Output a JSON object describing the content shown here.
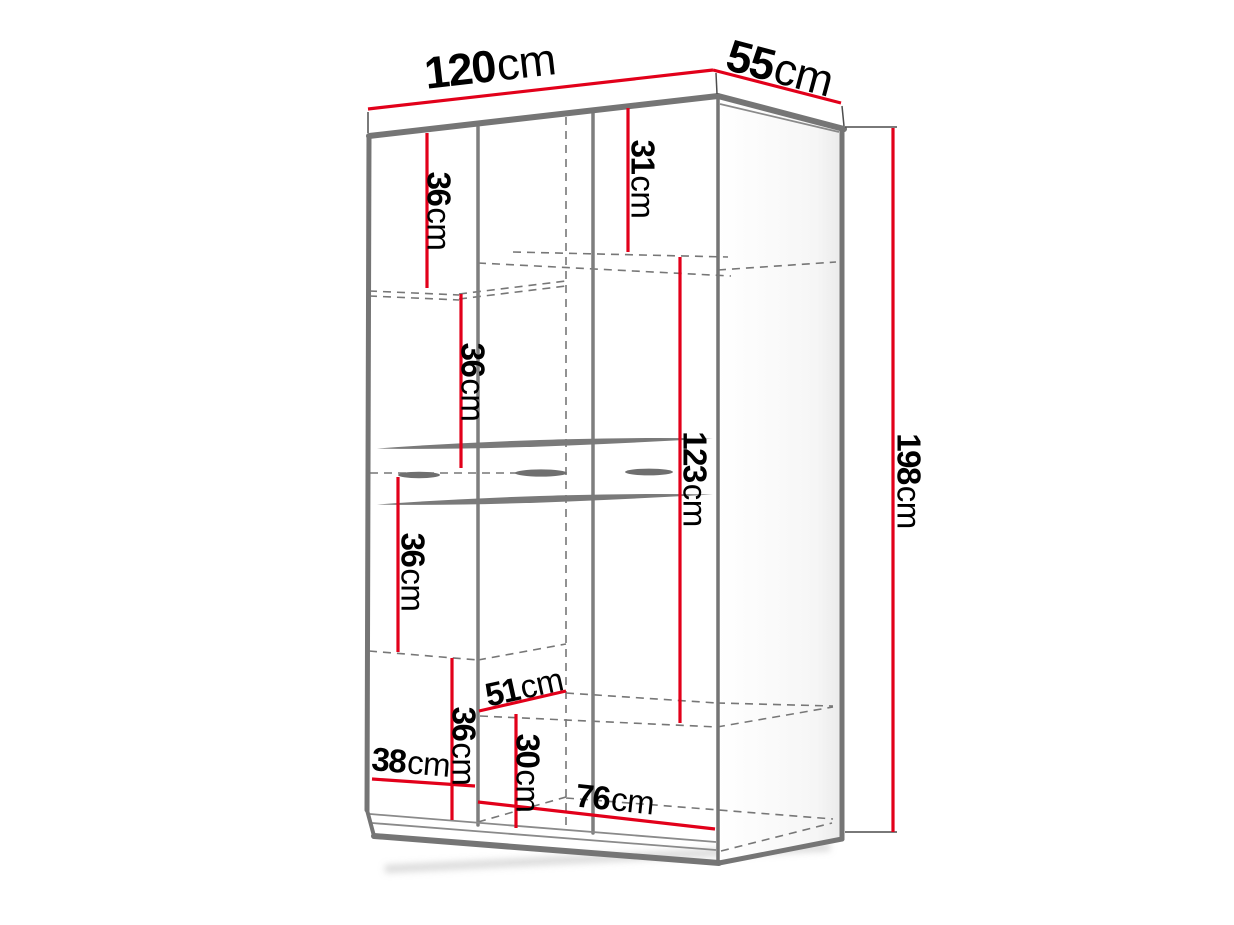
{
  "page": {
    "background": "#ffffff",
    "description": "Dimension diagram of a wardrobe shown in perspective with interior measurements"
  },
  "colors": {
    "dimension_line": "#e2001a",
    "cabinet_line": "#7a7a7a",
    "hidden_line": "#777777",
    "label_text": "#000000"
  },
  "unit": "cm",
  "labels": {
    "width_top": {
      "num": "120",
      "unit": "cm"
    },
    "depth_top": {
      "num": "55",
      "unit": "cm"
    },
    "height_right": {
      "num": "198",
      "unit": "cm"
    },
    "shelf_a": {
      "num": "36",
      "unit": "cm"
    },
    "top_right_section": {
      "num": "31",
      "unit": "cm"
    },
    "shelf_b": {
      "num": "36",
      "unit": "cm"
    },
    "hanging_space": {
      "num": "123",
      "unit": "cm"
    },
    "shelf_c": {
      "num": "36",
      "unit": "cm"
    },
    "shelf_d": {
      "num": "36",
      "unit": "cm"
    },
    "inner_depth": {
      "num": "51",
      "unit": "cm"
    },
    "bottom_compartment": {
      "num": "30",
      "unit": "cm"
    },
    "left_section_width": {
      "num": "38",
      "unit": "cm"
    },
    "right_section_width": {
      "num": "76",
      "unit": "cm"
    }
  }
}
